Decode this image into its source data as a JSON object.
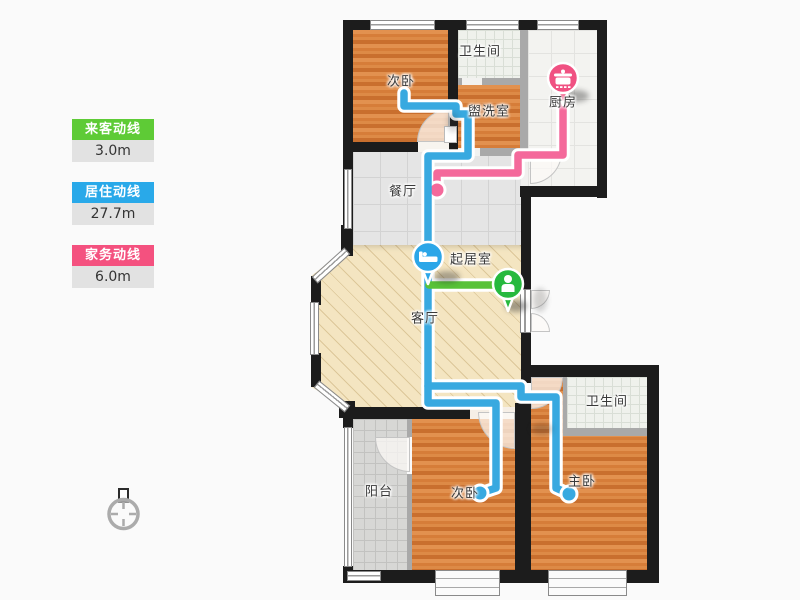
{
  "legend": {
    "items": [
      {
        "label": "来客动线",
        "value": "3.0m",
        "color": "#5ecb36"
      },
      {
        "label": "居住动线",
        "value": "27.7m",
        "color": "#29a9e9"
      },
      {
        "label": "家务动线",
        "value": "6.0m",
        "color": "#f4517f"
      }
    ]
  },
  "rooms": {
    "bedroom_top": "次卧",
    "bath_top": "卫生间",
    "washroom": "盥洗室",
    "kitchen": "厨房",
    "dining": "餐厅",
    "living": "起居室",
    "parlor": "客厅",
    "balcony": "阳台",
    "bedroom_bottom": "次卧",
    "master": "主卧",
    "bath_right": "卫生间"
  },
  "flow_lines": {
    "order": [
      "house",
      "living",
      "guest"
    ],
    "house": {
      "name": "家务动线",
      "color": "#f4699b",
      "paths": [
        [
          [
            563,
            100
          ],
          [
            563,
            155
          ],
          [
            518,
            155
          ],
          [
            518,
            173
          ],
          [
            437,
            173
          ],
          [
            437,
            187
          ]
        ]
      ],
      "end_dots": [
        [
          437,
          190
        ]
      ]
    },
    "living": {
      "name": "居住动线",
      "color": "#38a9e0",
      "paths": [
        [
          [
            404,
            93
          ],
          [
            404,
            106
          ],
          [
            456,
            106
          ],
          [
            456,
            114
          ],
          [
            468,
            114
          ],
          [
            468,
            156
          ],
          [
            428,
            156
          ],
          [
            428,
            403
          ],
          [
            496,
            403
          ],
          [
            496,
            488
          ],
          [
            481,
            493
          ]
        ],
        [
          [
            428,
            386
          ],
          [
            521,
            386
          ],
          [
            521,
            397
          ],
          [
            556,
            397
          ],
          [
            556,
            488
          ],
          [
            567,
            493
          ]
        ]
      ],
      "end_dots": [
        [
          480,
          493
        ],
        [
          569,
          494
        ]
      ]
    },
    "guest": {
      "name": "来客动线",
      "color": "#58c238",
      "paths": [
        [
          [
            429,
            285
          ],
          [
            506,
            285
          ]
        ]
      ],
      "end_dots": []
    }
  },
  "pins": [
    {
      "icon": "pot-icon",
      "color": "#f05182",
      "x": 563,
      "y": 78
    },
    {
      "icon": "bed-icon",
      "color": "#2ba6e8",
      "x": 428,
      "y": 257
    },
    {
      "icon": "person-icon",
      "color": "#27b93e",
      "x": 508,
      "y": 284
    }
  ],
  "compass": {
    "icon": "compass-icon"
  }
}
